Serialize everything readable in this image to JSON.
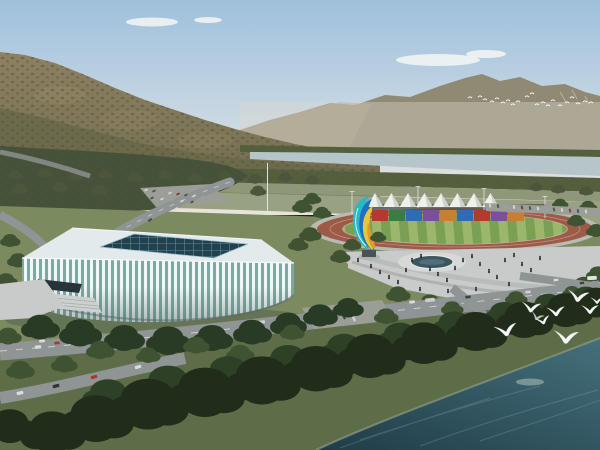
{
  "palette": {
    "sky_top": "#9fc0dc",
    "sky_mid": "#c9d8e3",
    "sky_horizon": "#e9e4da",
    "cloud": "#f4f6f4",
    "mountain_far": "#908a74",
    "mountain_far_light": "#a29b82",
    "mountain_haze": "#ddd7ca",
    "mountain_near_top": "#8d8162",
    "mountain_near_base": "#6e6b4d",
    "mountain_shadow": "#6a684a",
    "mountain_patch": "#9a8d68",
    "mountain_texture": "#55503c",
    "belt_trees": "#545f3e",
    "left_wood": "#45523a",
    "river_far": "#b5c5ca",
    "grass_far": "#8e9878",
    "fields": "#99a183",
    "ground": "#7c8a60",
    "grass_dark": "#5d6d47",
    "track_walk": "#b7bbb1",
    "track_ring": "#9d5a47",
    "infield_light": "#9cb76c",
    "infield_dark": "#7aa054",
    "tent_white": "#eef0ec",
    "tent_shade": "#cfd3cf",
    "fence": "#4a5148",
    "plaza": "#c8cbc9",
    "plaza_light": "#d6d9d7",
    "pool": "#3a565f",
    "pool_streak": "#567680",
    "people": "#2b3135",
    "stadium_roof": "#e3eaec",
    "stadium_skylight": "#22404e",
    "stadium_grid": "#5d8aa0",
    "stadium_glass": "#7ea8a1",
    "stadium_rib": "#f3f6f7",
    "stadium_canopy": "#27353b",
    "stairs": "#ccd0ce",
    "stadium_shadow": "#3c4a42",
    "road": "#8f9494",
    "road_mark": "#eceeec",
    "parking": "#9b9e97",
    "water_deep": "#203c47",
    "water_light": "#44707b",
    "water_streak": "#7fa0ab",
    "water_patch": "#b9c9bd",
    "shore": "#8d9a84",
    "bird": "#f7f9f8",
    "pole": "#e2e4e2",
    "sculpt_blue": "#1f6fc4",
    "sculpt_teal": "#2ab8c4",
    "sculpt_yellow": "#e8c83a",
    "sculpt_orange": "#e09a2e",
    "pedestal": "#4a5254",
    "trees": {
      "belt": "#4b563b",
      "mid": "#3f5232",
      "mid2": "#2e4026",
      "dark": "#2a3b25",
      "dark2": "#202d1b"
    }
  },
  "scene": {
    "clouds": [
      [
        152,
        22,
        26,
        4.5
      ],
      [
        208,
        20,
        14,
        3
      ],
      [
        438,
        60,
        42,
        6
      ],
      [
        486,
        54,
        20,
        4
      ]
    ],
    "tents": {
      "count": 8,
      "x_start": 375,
      "spacing": 16.5,
      "peak_y": 193,
      "base_y": 207,
      "half_w": 8.5
    },
    "containers": {
      "y": 210,
      "h": 11,
      "w": 16,
      "items": [
        {
          "x": 372,
          "c": "#b23a2e"
        },
        {
          "x": 389,
          "c": "#3a7d44"
        },
        {
          "x": 406,
          "c": "#2e6db4"
        },
        {
          "x": 423,
          "c": "#7a4fa0"
        },
        {
          "x": 440,
          "c": "#c87f2f"
        },
        {
          "x": 457,
          "c": "#2e6db4"
        },
        {
          "x": 474,
          "c": "#b23a2e"
        },
        {
          "x": 491,
          "c": "#7a4fa0"
        },
        {
          "x": 508,
          "c": "#c87f2f"
        }
      ]
    },
    "gulls": [
      [
        506,
        331,
        1.0,
        -10
      ],
      [
        531,
        308,
        0.85,
        6
      ],
      [
        556,
        312,
        0.8,
        -4
      ],
      [
        578,
        297,
        0.95,
        8
      ],
      [
        590,
        310,
        0.75,
        0
      ],
      [
        543,
        321,
        0.65,
        -14
      ],
      [
        566,
        338,
        1.1,
        4
      ],
      [
        597,
        301,
        0.55,
        0
      ],
      [
        537,
        317,
        0.6,
        20,
        0.75
      ]
    ],
    "far_flock": [
      [
        470,
        98
      ],
      [
        480,
        97
      ],
      [
        485,
        100
      ],
      [
        492,
        102
      ],
      [
        497,
        99
      ],
      [
        503,
        103
      ],
      [
        508,
        101
      ],
      [
        513,
        105
      ],
      [
        518,
        102
      ],
      [
        527,
        97
      ],
      [
        532,
        94
      ],
      [
        537,
        105
      ],
      [
        543,
        103
      ],
      [
        548,
        106
      ],
      [
        553,
        101
      ],
      [
        560,
        106
      ],
      [
        567,
        103
      ],
      [
        572,
        98
      ],
      [
        578,
        104
      ],
      [
        585,
        102
      ],
      [
        591,
        103
      ]
    ],
    "people": [
      [
        371,
        268
      ],
      [
        380,
        274
      ],
      [
        389,
        279
      ],
      [
        398,
        284
      ],
      [
        406,
        272
      ],
      [
        412,
        262
      ],
      [
        421,
        258
      ],
      [
        430,
        271
      ],
      [
        438,
        276
      ],
      [
        447,
        282
      ],
      [
        455,
        270
      ],
      [
        463,
        262
      ],
      [
        472,
        258
      ],
      [
        480,
        266
      ],
      [
        489,
        273
      ],
      [
        497,
        279
      ],
      [
        505,
        262
      ],
      [
        514,
        257
      ],
      [
        522,
        266
      ],
      [
        531,
        272
      ],
      [
        540,
        260
      ],
      [
        476,
        291
      ],
      [
        448,
        293
      ],
      [
        420,
        291
      ],
      [
        392,
        294
      ],
      [
        509,
        286
      ],
      [
        366,
        255
      ],
      [
        358,
        262
      ],
      [
        28,
        292
      ],
      [
        38,
        296
      ],
      [
        20,
        300
      ]
    ],
    "buses": [
      [
        170,
        332,
        "#c9cdcf",
        -6
      ],
      [
        330,
        312,
        "#3f464c",
        -6
      ],
      [
        430,
        300,
        "#c9cdcf",
        -5
      ],
      [
        592,
        278,
        "#dfe3e4",
        -3
      ]
    ],
    "cars": [
      [
        38,
        347,
        "#d9dcde",
        1
      ],
      [
        74,
        343,
        "#2f363b",
        1
      ],
      [
        118,
        339,
        "#a8392e",
        1
      ],
      [
        214,
        328,
        "#3a4147",
        1
      ],
      [
        262,
        322,
        "#ced2d5",
        0.95
      ],
      [
        310,
        316,
        "#8f2f28",
        0.95
      ],
      [
        358,
        309,
        "#2f363b",
        0.9
      ],
      [
        412,
        302,
        "#d9dcde",
        0.9
      ],
      [
        468,
        297,
        "#3a4147",
        0.85
      ],
      [
        528,
        292,
        "#ced2d5",
        0.85
      ],
      [
        20,
        393,
        "#d9dcde",
        1.05,
        -12
      ],
      [
        56,
        386,
        "#2f363b",
        1.05,
        -14
      ],
      [
        94,
        377,
        "#a8392e",
        1,
        -16
      ],
      [
        138,
        367,
        "#d9dcde",
        1,
        -16
      ],
      [
        18,
        338,
        "#23292e",
        0.9
      ],
      [
        42,
        341,
        "#d9dcde",
        0.9
      ],
      [
        57,
        343,
        "#a8392e",
        0.85
      ],
      [
        314,
        312,
        "#ced2d5",
        0.75,
        60
      ],
      [
        324,
        314,
        "#454c52",
        0.75,
        60
      ],
      [
        334,
        316,
        "#ced2d5",
        0.75,
        60
      ],
      [
        344,
        317,
        "#454c52",
        0.75,
        60
      ],
      [
        354,
        319,
        "#ced2d5",
        0.75,
        60
      ],
      [
        556,
        280,
        "#d9dcde",
        0.75
      ],
      [
        582,
        283,
        "#3a4147",
        0.7
      ],
      [
        146,
        190,
        "#cfd3d6",
        0.55,
        -25
      ],
      [
        154,
        191,
        "#4a5258",
        0.55,
        -25
      ],
      [
        162,
        192,
        "#9aa0a4",
        0.55,
        -25
      ],
      [
        170,
        193,
        "#cfd3d6",
        0.55,
        -25
      ],
      [
        178,
        194,
        "#7e3a32",
        0.55,
        -25
      ],
      [
        186,
        195,
        "#4a5258",
        0.55,
        -25
      ],
      [
        194,
        196,
        "#cfd3d6",
        0.55,
        -25
      ],
      [
        202,
        197,
        "#9aa0a4",
        0.55,
        -25
      ],
      [
        152,
        198,
        "#4a5258",
        0.55,
        -25
      ],
      [
        162,
        199,
        "#cfd3d6",
        0.55,
        -25
      ],
      [
        172,
        200,
        "#9aa0a4",
        0.55,
        -25
      ],
      [
        182,
        201,
        "#cfd3d6",
        0.55,
        -25
      ],
      [
        192,
        202,
        "#4a5258",
        0.55,
        -25
      ],
      [
        176,
        209,
        "#d9dcde",
        0.7,
        -30
      ],
      [
        150,
        220,
        "#4a5258",
        0.7,
        -35
      ],
      [
        490,
        205.5,
        "#d2d6d8",
        0.6,
        78
      ],
      [
        498,
        206,
        "#4d555b",
        0.6,
        78
      ],
      [
        506,
        206.5,
        "#9aa0a4",
        0.6,
        78
      ],
      [
        514,
        207,
        "#d2d6d8",
        0.6,
        78
      ],
      [
        522,
        207.5,
        "#70403a",
        0.6,
        78
      ],
      [
        530,
        208,
        "#4d555b",
        0.6,
        78
      ],
      [
        538,
        208.5,
        "#d2d6d8",
        0.6,
        78
      ],
      [
        546,
        209,
        "#9aa0a4",
        0.6,
        78
      ],
      [
        554,
        209.5,
        "#4d555b",
        0.6,
        78
      ],
      [
        562,
        210,
        "#d2d6d8",
        0.6,
        78
      ],
      [
        570,
        210.5,
        "#844038",
        0.6,
        78
      ],
      [
        578,
        211,
        "#4d555b",
        0.6,
        78
      ],
      [
        586,
        211.5,
        "#d2d6d8",
        0.6,
        78
      ],
      [
        594,
        212,
        "#9aa0a4",
        0.6,
        78
      ]
    ],
    "tree_groups": [
      {
        "name": "greenbelt",
        "tone": "belt",
        "items": [
          [
            15,
            176,
            0.7
          ],
          [
            45,
            174,
            0.7
          ],
          [
            75,
            177,
            0.75
          ],
          [
            105,
            175,
            0.7
          ],
          [
            135,
            178,
            0.75
          ],
          [
            165,
            176,
            0.7
          ],
          [
            195,
            179,
            0.75
          ],
          [
            225,
            177,
            0.7
          ],
          [
            255,
            180,
            0.75
          ],
          [
            285,
            178,
            0.7
          ],
          [
            312,
            181,
            0.7
          ],
          [
            20,
            190,
            0.8
          ],
          [
            60,
            188,
            0.8
          ],
          [
            100,
            191,
            0.8
          ],
          [
            258,
            192,
            0.8
          ],
          [
            558,
            190,
            0.7
          ],
          [
            586,
            192,
            0.7
          ],
          [
            536,
            188,
            0.65
          ]
        ]
      },
      {
        "name": "trackside",
        "tone": "mid",
        "items": [
          [
            312,
            200,
            0.9
          ],
          [
            302,
            208,
            1.0
          ],
          [
            322,
            214,
            0.9
          ],
          [
            560,
            205,
            0.8
          ],
          [
            588,
            208,
            0.9
          ],
          [
            576,
            222,
            0.9
          ],
          [
            596,
            232,
            1.0
          ],
          [
            310,
            236,
            1.1
          ],
          [
            298,
            246,
            1.0
          ]
        ]
      },
      {
        "name": "plaza",
        "tone": "mid",
        "items": [
          [
            352,
            246,
            0.9
          ],
          [
            340,
            258,
            1.0
          ],
          [
            378,
            238,
            0.8
          ],
          [
            520,
            306,
            1.4
          ],
          [
            556,
            300,
            1.5
          ],
          [
            584,
            288,
            1.4
          ],
          [
            598,
            276,
            1.2
          ],
          [
            468,
            306,
            1.3
          ],
          [
            430,
            304,
            1.2
          ],
          [
            398,
            296,
            1.2
          ],
          [
            10,
            242,
            1.0
          ],
          [
            18,
            262,
            1.1
          ],
          [
            6,
            282,
            1.1
          ]
        ]
      },
      {
        "name": "stadium-front",
        "tone": "dark",
        "items": [
          [
            40,
            330,
            1.9
          ],
          [
            80,
            336,
            2.1
          ],
          [
            124,
            341,
            2.0
          ],
          [
            168,
            344,
            2.2
          ],
          [
            212,
            341,
            2.0
          ],
          [
            252,
            335,
            1.9
          ],
          [
            288,
            327,
            1.8
          ],
          [
            320,
            318,
            1.7
          ],
          [
            348,
            310,
            1.5
          ]
        ]
      },
      {
        "name": "boulevard",
        "tone": "mid",
        "items": [
          [
            8,
            338,
            1.3
          ],
          [
            100,
            352,
            1.4
          ],
          [
            196,
            347,
            1.3
          ],
          [
            292,
            334,
            1.2
          ],
          [
            386,
            318,
            1.2
          ],
          [
            452,
            310,
            1.1
          ],
          [
            516,
            300,
            1.1
          ],
          [
            572,
            294,
            1.0
          ],
          [
            20,
            372,
            1.4
          ],
          [
            64,
            366,
            1.3
          ],
          [
            148,
            357,
            1.2
          ],
          [
            240,
            356,
            1.4
          ]
        ]
      },
      {
        "name": "foreground-back",
        "tone": "mid2",
        "items": [
          [
            108,
            400,
            2.6
          ],
          [
            168,
            388,
            2.8
          ],
          [
            228,
            377,
            2.6
          ],
          [
            288,
            365,
            2.5
          ],
          [
            344,
            353,
            2.4
          ],
          [
            400,
            341,
            2.3
          ],
          [
            454,
            329,
            2.2
          ],
          [
            504,
            318,
            2.0
          ],
          [
            548,
            309,
            1.9
          ],
          [
            586,
            301,
            1.8
          ]
        ]
      },
      {
        "name": "foreground",
        "tone": "dark2",
        "items": [
          [
            10,
            430,
            2.6
          ],
          [
            52,
            437,
            3.2
          ],
          [
            96,
            424,
            3.6
          ],
          [
            148,
            410,
            3.9
          ],
          [
            205,
            398,
            3.8
          ],
          [
            262,
            386,
            3.7
          ],
          [
            316,
            374,
            3.5
          ],
          [
            370,
            361,
            3.4
          ],
          [
            424,
            348,
            3.2
          ],
          [
            476,
            336,
            3.0
          ],
          [
            524,
            324,
            2.8
          ],
          [
            566,
            314,
            2.6
          ],
          [
            596,
            306,
            2.3
          ]
        ]
      }
    ]
  }
}
